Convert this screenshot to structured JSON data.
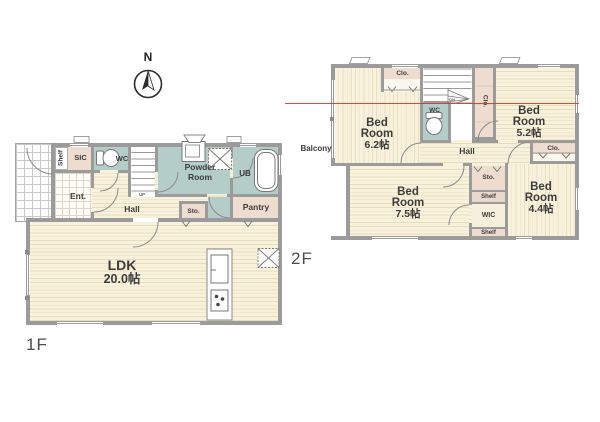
{
  "page": {
    "background": "#ffffff"
  },
  "compass": {
    "north_label": "N"
  },
  "colors": {
    "wall": "#9b9b9b",
    "wet_room": "#b5cdc9",
    "storage_room": "#eedccf",
    "wood_floor": "#f8f2dd",
    "scan_line_red": "#cc4227"
  },
  "floor1": {
    "label": "1F",
    "rooms": {
      "shelf": "Shelf",
      "sic": "SIC",
      "wc": "WC",
      "ent": "Ent.",
      "hall": "Hall",
      "powder_room": "Powder Room",
      "ub": "UB",
      "sto": "Sto.",
      "pantry": "Pantry",
      "ldk": "LDK",
      "ldk_size": "20.0帖",
      "stairs_up": "UP"
    }
  },
  "floor2": {
    "label": "2F",
    "rooms": {
      "balcony": "Balcony",
      "closet_top": "Clo.",
      "closet_mid": "Clo.",
      "closet_right": "Clo.",
      "bedroom_62": "Bed Room",
      "bedroom_62_size": "6.2帖",
      "bedroom_52": "Bed Room",
      "bedroom_52_size": "5.2帖",
      "bedroom_75": "Bed Room",
      "bedroom_75_size": "7.5帖",
      "bedroom_44": "Bed Room",
      "bedroom_44_size": "4.4帖",
      "wc": "WC",
      "hall": "Hall",
      "sto": "Sto.",
      "shelf_upper": "Shelf",
      "shelf_lower": "Shelf",
      "wic": "WIC",
      "stairs_down": "DN"
    }
  }
}
